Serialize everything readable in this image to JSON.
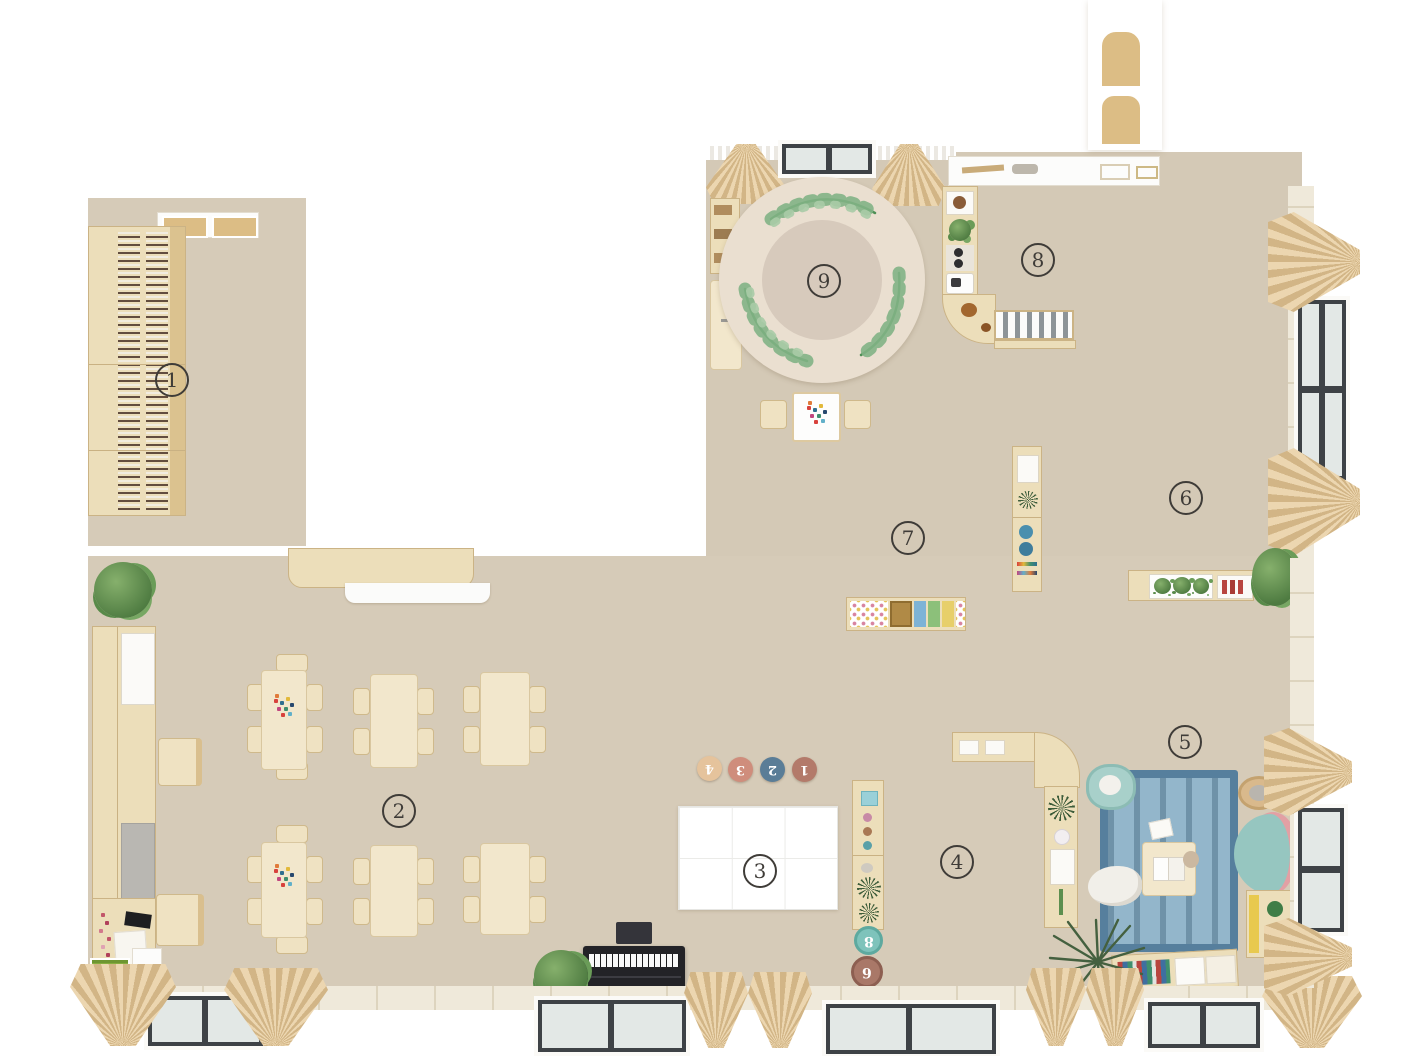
{
  "zones": {
    "z1": "1",
    "z2": "2",
    "z3": "3",
    "z4": "4",
    "z5": "5",
    "z6": "6",
    "z7": "7",
    "z8": "8",
    "z9": "9"
  },
  "floor_cushions": {
    "c1": "4",
    "c2": "3",
    "c3": "2",
    "c4": "1"
  },
  "stools": {
    "top": "8",
    "bottom": "6"
  },
  "colors": {
    "floor": "#d6cbb8",
    "wood": "#ecdeba",
    "wood_border": "#cbb385",
    "round_rug": "#eadfd0",
    "round_rug_center": "#d7cabc",
    "leaf_green": "#5f9e63",
    "blue_rug": "#93b6cb",
    "blue_rug_border": "#567f9d",
    "sofa_teal": "#96c6c0",
    "sofa_pink": "#e2a0a4",
    "stool_8": "#7ec3bb",
    "stool_6": "#a97868",
    "cushion_4": "#e5c39c",
    "cushion_3": "#cf8d7c",
    "cushion_2": "#5a7d97",
    "cushion_1": "#b37a6a",
    "piano": "#232327",
    "curtain": "#d9bd92",
    "window_frame": "#3e4246"
  }
}
